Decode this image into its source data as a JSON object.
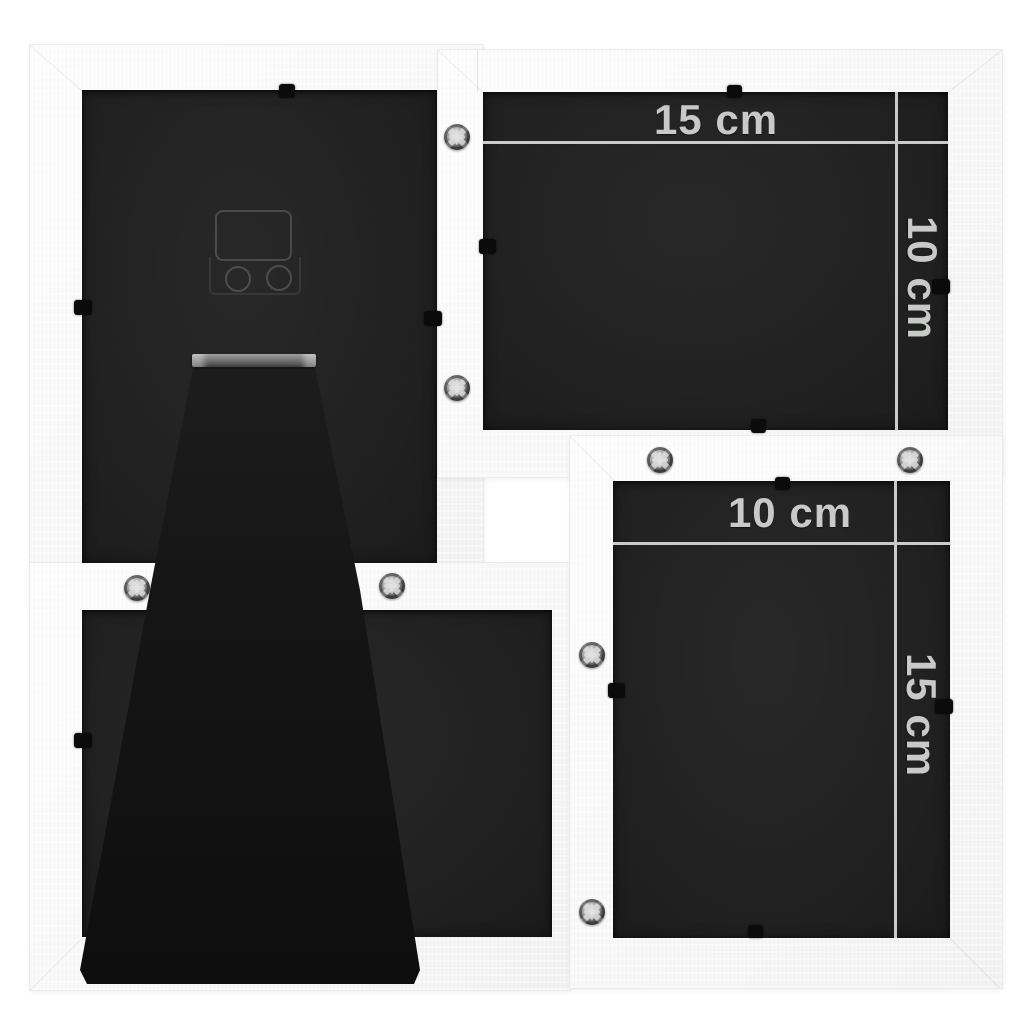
{
  "image": {
    "type": "product-photo",
    "subject": "Back view of a white 4-opening collage photo frame with fold-out stand, wall hanger, retaining clips and assembly screws",
    "background_color": "#ffffff"
  },
  "frame": {
    "wood_color": "#f8f8f8",
    "edge_color": "#ebebeb",
    "backing_color": "#222222",
    "stand_color": "#141414",
    "hinge_color": "#8a8a8a",
    "screw_color": "#9c9c9c",
    "screw_count": 8,
    "clip_count": 12
  },
  "annotations": {
    "line_color": "#cbcbcb",
    "text_color": "#c7cac7",
    "top_right_opening": {
      "width_label": "15 cm",
      "height_label": "10 cm"
    },
    "bottom_right_opening": {
      "width_label": "10 cm",
      "height_label": "15 cm"
    }
  }
}
